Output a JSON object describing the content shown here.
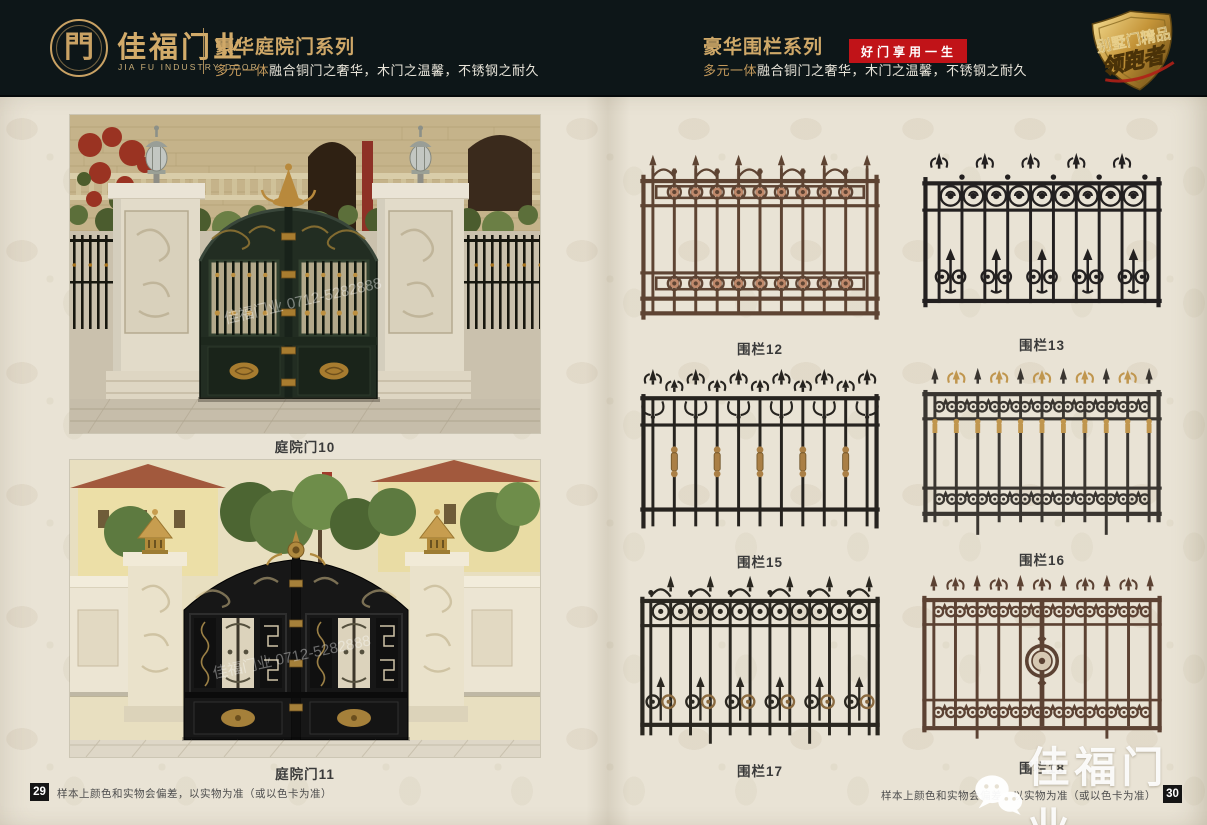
{
  "header": {
    "logo": {
      "symbol": "門",
      "brand": "佳福门业",
      "brand_en": "JIA FU INDUSTRY DOOR"
    },
    "left_series": {
      "title": "豪华庭院门系列",
      "subtitle_gold": "多元一体",
      "subtitle_rest": "融合铜门之奢华，木门之温馨，不锈钢之耐久"
    },
    "right_series": {
      "title": "豪华围栏系列",
      "badge": "好门享用一生",
      "subtitle_gold": "多元一体",
      "subtitle_rest": "融合铜门之奢华，木门之温馨，不锈钢之耐久"
    },
    "emblem": {
      "line1": "别墅门精品",
      "line2": "领跑者"
    },
    "colors": {
      "background": "#0d1618",
      "gold": "#cfa868",
      "badge_red": "#c11318"
    }
  },
  "left_page": {
    "page_number": "29",
    "disclaimer": "样本上颜色和实物会偏差，以实物为准（或以色卡为准）",
    "products": [
      {
        "label": "庭院门10",
        "kind": "courtyard-gate-photo"
      },
      {
        "label": "庭院门11",
        "kind": "courtyard-gate-photo"
      }
    ]
  },
  "right_page": {
    "page_number": "30",
    "disclaimer": "样本上颜色和实物会偏差，以实物为准（或以色卡为准）",
    "products": [
      {
        "label": "围栏12",
        "variant": "double-band-rosette",
        "colors": {
          "main": "#5e4433",
          "accent": "#c08a6c"
        }
      },
      {
        "label": "围栏13",
        "variant": "circle-band-fleur",
        "colors": {
          "main": "#232020",
          "accent": "#232020"
        }
      },
      {
        "label": "围栏15",
        "variant": "fleur-collar",
        "colors": {
          "main": "#26231f",
          "accent": "#aa7f45"
        }
      },
      {
        "label": "围栏16",
        "variant": "gold-fleur",
        "colors": {
          "main": "#3a3631",
          "accent": "#c0964e"
        }
      },
      {
        "label": "围栏17",
        "variant": "circle-scroll",
        "colors": {
          "main": "#2a2720",
          "accent": "#8a6a40"
        }
      },
      {
        "label": "围栏18",
        "variant": "center-medallion",
        "colors": {
          "main": "#5c4233",
          "accent": "#d6c8b2"
        }
      }
    ]
  },
  "watermark": {
    "brand": "佳福门业",
    "photo_text": "佳福门业 0712-5282888"
  }
}
